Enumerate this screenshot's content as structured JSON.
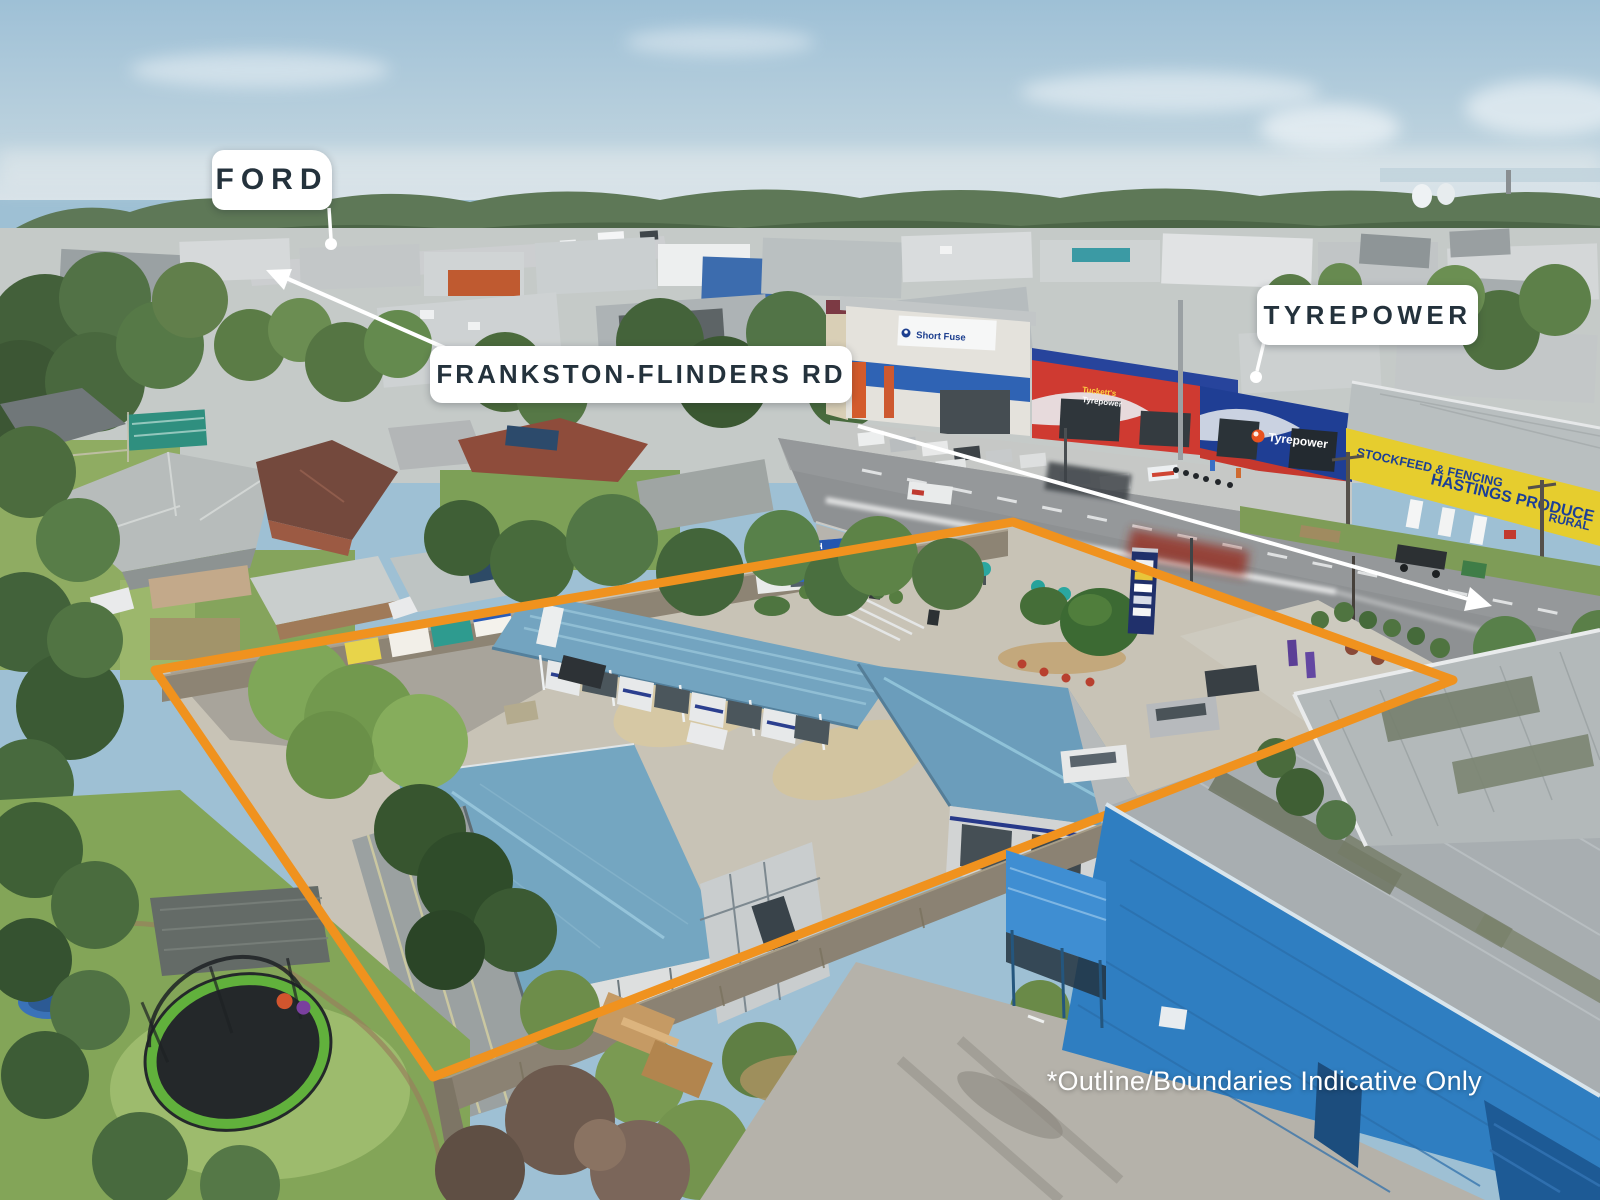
{
  "annotations": {
    "ford_label": "FORD",
    "road_label": "FRANKSTON-FLINDERS RD",
    "tyrepower_label": "TYREPOWER",
    "disclaimer": "*Outline/Boundaries Indicative Only"
  },
  "photo_signage": {
    "dog_wash": "DOG WASH",
    "tyrepower_fascia": "Tyrepower",
    "tucketts_line1": "Tuckett's",
    "tucketts_line2": "Tyrepower",
    "short_fuse": "Short Fuse",
    "stockfeed": "STOCKFEED & FENCING",
    "hastings": "HASTINGS PRODUCE",
    "rural": "RURAL"
  },
  "colors": {
    "boundary": "#F0921E",
    "label_text": "#24323C",
    "label_bg": "#FFFFFF"
  }
}
